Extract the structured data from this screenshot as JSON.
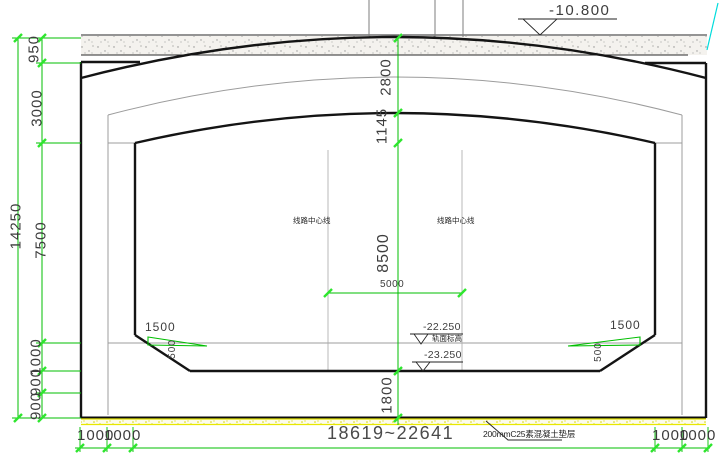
{
  "elevations": {
    "ground": "-10.800",
    "rail": "-22.250",
    "rail_caption": "轨面标高",
    "invert": "-23.250"
  },
  "annotations": {
    "track_centerline_left": "线路中心线",
    "track_centerline_right": "线路中心线",
    "cushion_note": "200mmC25素混凝土垫层"
  },
  "dimensions": {
    "overall_height": "14250",
    "left_chain": [
      "950",
      "3000",
      "7500",
      "1000",
      "900",
      "900"
    ],
    "center_chain": [
      "2800",
      "1145",
      "8500",
      "1800"
    ],
    "track_spacing": "5000",
    "slope_width_left": "1500",
    "slope_width_right": "1500",
    "chamfer_left": "500",
    "chamfer_right": "500",
    "bottom_left": [
      "1000",
      "1000"
    ],
    "bottom_span": "18619~22641",
    "bottom_right": [
      "1000",
      "1000"
    ]
  },
  "colors": {
    "dimension_green": "#00bf00",
    "tick_green": "#2ee62e",
    "cushion_yellow": "#e8e800",
    "guide_cyan": "#00dcdc",
    "structure_black": "#141414",
    "lining_gray": "#9c9c9c"
  }
}
